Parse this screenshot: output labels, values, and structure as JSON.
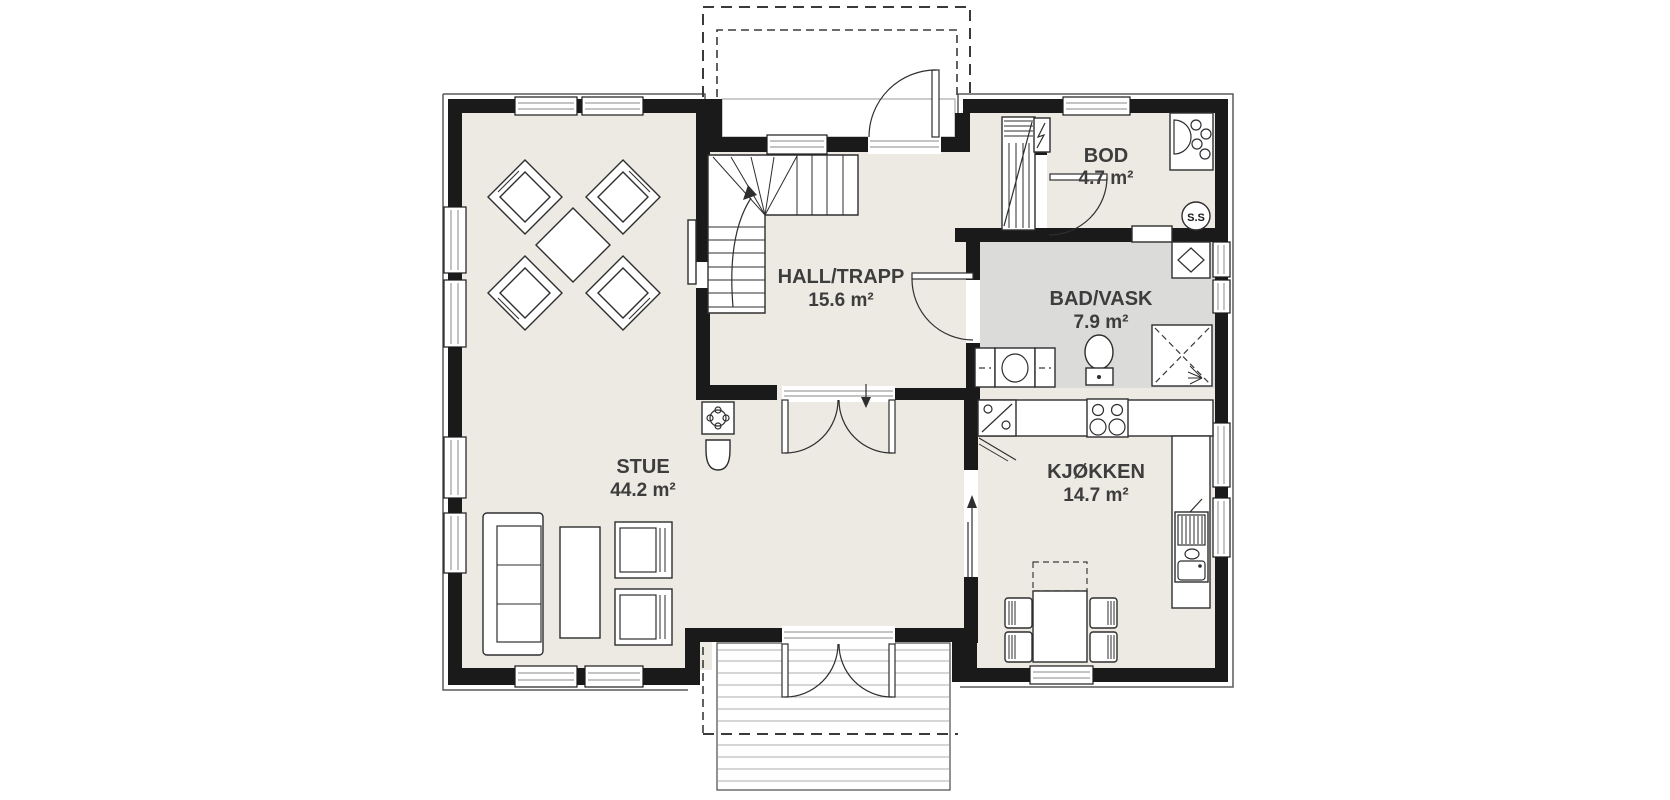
{
  "rooms": [
    {
      "id": "stue",
      "name": "STUE",
      "area": "44.2 m²"
    },
    {
      "id": "hall",
      "name": "HALL/TRAPP",
      "area": "15.6 m²"
    },
    {
      "id": "bod",
      "name": "BOD",
      "area": "4.7 m²"
    },
    {
      "id": "bad",
      "name": "BAD/VASK",
      "area": "7.9 m²"
    },
    {
      "id": "kjokken",
      "name": "KJØKKEN",
      "area": "14.7 m²"
    }
  ],
  "annotations": {
    "central_vacuum_label": "S.S"
  },
  "fixtures": [
    "staircase-up",
    "wood-stove",
    "chimney",
    "sofa",
    "coffee-table",
    "armchair",
    "dining-set-diamond",
    "entry-door",
    "entry-porch-roof-dashed",
    "interior-double-door",
    "terrace-double-door",
    "terrace-deck",
    "kitchen-counter",
    "corner-cabinet",
    "cooktop",
    "kitchen-sink",
    "kitchen-table-with-chairs",
    "sliding-opening-arrow",
    "toilet",
    "washing-machine",
    "shower-corner",
    "water-heater",
    "laundry-sink",
    "vent-duct",
    "electrical-panel",
    "wall-niche",
    "windows"
  ],
  "colors": {
    "wall": "#1a1a1a",
    "floor": "#eceae3",
    "wet_floor": "#dbdbda",
    "background": "#ffffff",
    "line": "#2e2e2e",
    "text": "#3d3d3d"
  }
}
